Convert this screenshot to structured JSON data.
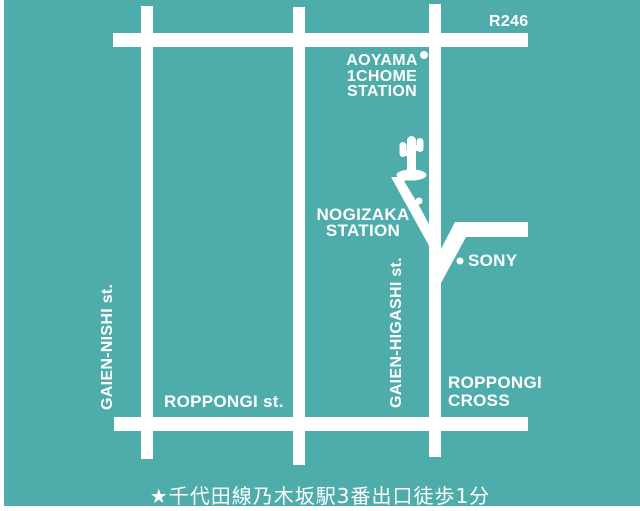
{
  "colors": {
    "background": "#4EACAA",
    "road": "#FFFFFF",
    "text": "#FFFFFF",
    "page_border": "#FFFFFF"
  },
  "labels": {
    "route": "R246",
    "aoyama_line1": "AOYAMA",
    "aoyama_line2": "1CHOME",
    "aoyama_line3": "STATION",
    "nogizaka_line1": "NOGIZAKA",
    "nogizaka_line2": "STATION",
    "sony": "SONY",
    "gaien_nishi": "GAIEN-NISHI st.",
    "gaien_higashi": "GAIEN-HIGASHI st.",
    "roppongi_street": "ROPPONGI st.",
    "roppongi_cross_line1": "ROPPONGI",
    "roppongi_cross_line2": "CROSS"
  },
  "caption": "★千代田線乃木坂駅3番出口徒歩1分",
  "icons": {
    "landmark": "cactus-icon",
    "aoyama_marker": "station-dot-icon",
    "nogizaka_marker": "station-dot-icon",
    "sony_marker": "location-dot-icon"
  }
}
